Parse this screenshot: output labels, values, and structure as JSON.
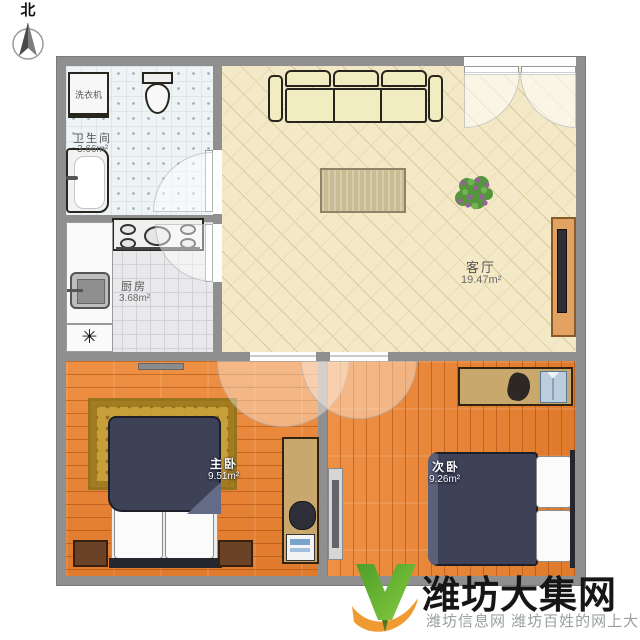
{
  "compass": {
    "label": "北"
  },
  "plan": {
    "rooms": {
      "bathroom": {
        "name": "卫生间",
        "area": "3.66m²"
      },
      "kitchen": {
        "name": "厨房",
        "area": "3.68m²"
      },
      "living": {
        "name": "客厅",
        "area": "19.47m²"
      },
      "master": {
        "name": "主卧",
        "area": "9.51m²"
      },
      "second": {
        "name": "次卧",
        "area": "9.26m²"
      }
    },
    "appliances": {
      "washer": "洗衣机",
      "drain_symbol": "✳"
    }
  },
  "watermark": {
    "title": "潍坊大集网",
    "subtitle": "潍坊信息网 潍坊百姓的网上大集"
  },
  "colors": {
    "wall": "#8f8f8f",
    "living_floor": "#f3e9c6",
    "wood_floor": "#e8863a",
    "brand_green": "#5aa62e",
    "brand_orange": "#f09a32"
  }
}
